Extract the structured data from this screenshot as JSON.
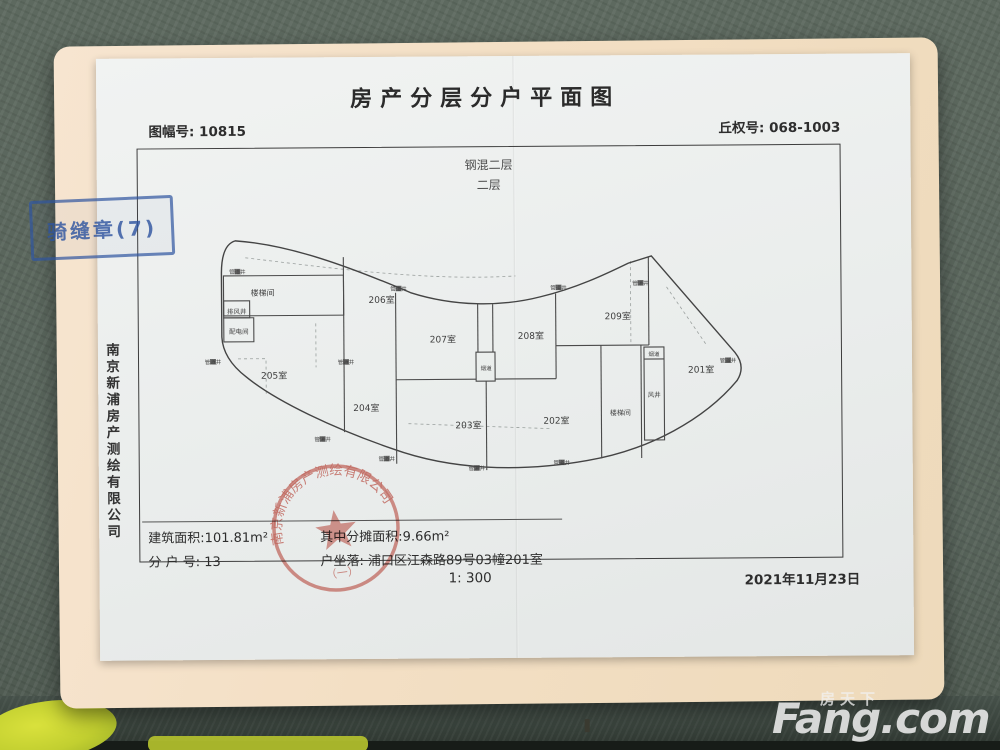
{
  "colors": {
    "seal_red": "#c23b2e",
    "stamp_blue": "#2f55a0",
    "folder_cream": "#f3dfc4",
    "desk_green": "#57635a",
    "paper_white": "#eaedec",
    "highlight_yellow": "#c2cf30"
  },
  "watermark": {
    "cn": "房天下",
    "en": "Fang.com"
  },
  "stamps": {
    "edge_stamp": "骑缝章(7)",
    "seal_arc": "南京新浦房产测绘有限公司",
    "seal_bottom": "（一）"
  },
  "document": {
    "title": "房产分层分户平面图",
    "sheet_no_label": "图幅号:",
    "sheet_no": "10815",
    "plot_no_label": "丘权号:",
    "plot_no": "068-1003",
    "structure": "钢混二层",
    "floor": "二层",
    "company": "南京新浦房产测绘有限公司",
    "area_label": "建筑面积:",
    "area": "101.81m²",
    "shared_label": "其中分摊面积:",
    "shared": "9.66m²",
    "unit_label": "分 户 号:",
    "unit": "13",
    "location_label": "户坐落:",
    "location": "浦口区江森路89号03幢201室",
    "scale": "1: 300",
    "date": "2021年11月23日"
  },
  "plan": {
    "labels": {
      "pipe": "管道井",
      "stair": "楼梯间",
      "exhaust": "排风井",
      "power": "配电间",
      "flue": "烟道",
      "wind": "风井"
    },
    "rooms": [
      {
        "label": "201室",
        "x": 515,
        "y": 148
      },
      {
        "label": "202室",
        "x": 370,
        "y": 198
      },
      {
        "label": "203室",
        "x": 282,
        "y": 202
      },
      {
        "label": "204室",
        "x": 180,
        "y": 184
      },
      {
        "label": "205室",
        "x": 88,
        "y": 151
      },
      {
        "label": "206室",
        "x": 196,
        "y": 76
      },
      {
        "label": "207室",
        "x": 257,
        "y": 116
      },
      {
        "label": "208室",
        "x": 345,
        "y": 113
      },
      {
        "label": "209室",
        "x": 432,
        "y": 94
      }
    ],
    "annotations": [
      {
        "label": "楼梯间",
        "x": 77,
        "y": 68,
        "size": 8
      },
      {
        "label": "排风井",
        "x": 51,
        "y": 86,
        "size": 6.5
      },
      {
        "label": "配电间",
        "x": 53,
        "y": 106,
        "size": 6.5
      },
      {
        "label": "楼梯间",
        "x": 434,
        "y": 190,
        "size": 7
      },
      {
        "label": "风井",
        "x": 468,
        "y": 172,
        "size": 6.5
      },
      {
        "label": "烟道",
        "x": 300,
        "y": 144,
        "size": 5.5
      },
      {
        "label": "烟道",
        "x": 468,
        "y": 131,
        "size": 5.5
      }
    ],
    "pipe_markers": [
      {
        "x": 52,
        "y": 46
      },
      {
        "x": 213,
        "y": 64
      },
      {
        "x": 373,
        "y": 64
      },
      {
        "x": 455,
        "y": 60
      },
      {
        "x": 542,
        "y": 138
      },
      {
        "x": 27,
        "y": 136
      },
      {
        "x": 136,
        "y": 214
      },
      {
        "x": 200,
        "y": 234
      },
      {
        "x": 290,
        "y": 244
      },
      {
        "x": 375,
        "y": 239
      },
      {
        "x": 160,
        "y": 137
      }
    ]
  }
}
